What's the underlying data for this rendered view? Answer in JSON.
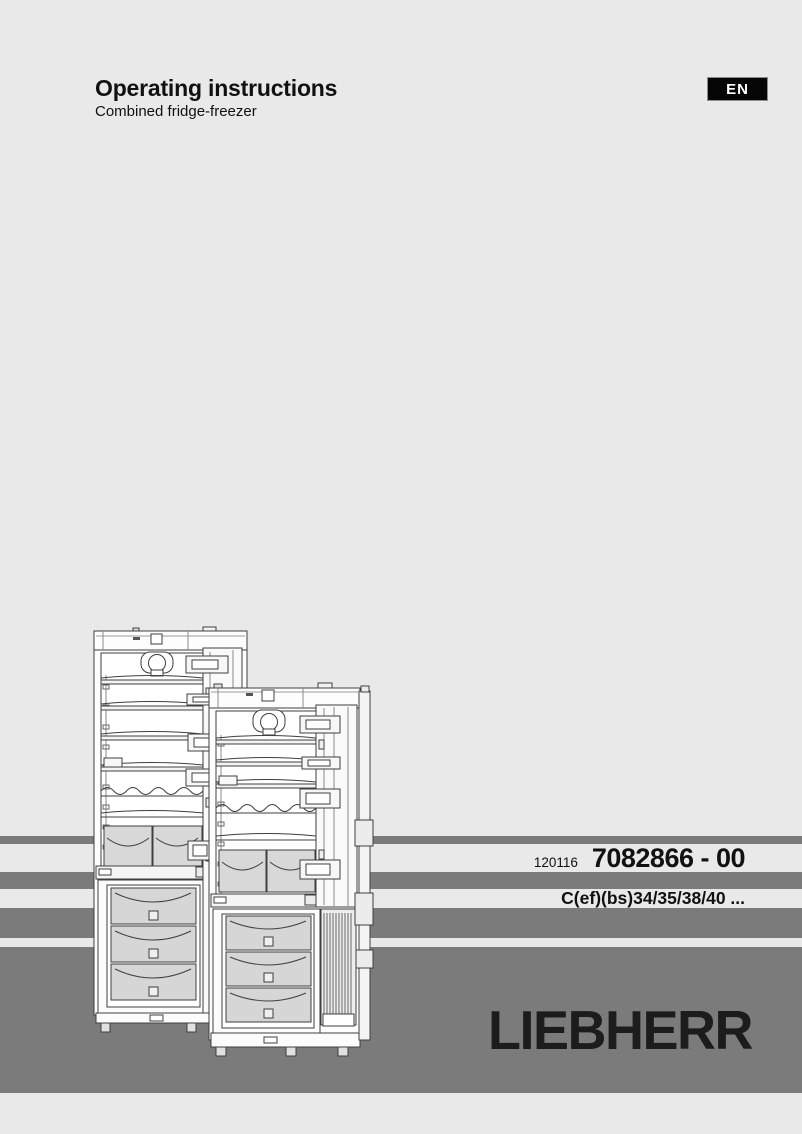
{
  "header": {
    "title": "Operating instructions",
    "subtitle": "Combined fridge-freezer",
    "language_badge": "EN"
  },
  "product_plate": {
    "print_code": "120116",
    "document_number": "7082866 - 00",
    "model_range": "C(ef)(bs)34/35/38/40 ..."
  },
  "brand": {
    "logo_text": "LIEBHERR"
  },
  "illustration": {
    "name": "fridge-freezer-line-drawing",
    "description": "Line drawing of two combined fridge-freezers with doors open: refrigerator compartment with fan, shelves, door bins and crisper drawers on top; freezer compartment with three drawers below"
  },
  "colors": {
    "page_background": "#e9e9e9",
    "band_gray": "#7b7b7b",
    "badge_background": "#050505",
    "badge_text": "#ffffff",
    "text_color": "#111111",
    "logo_color": "#1c1c1c"
  }
}
